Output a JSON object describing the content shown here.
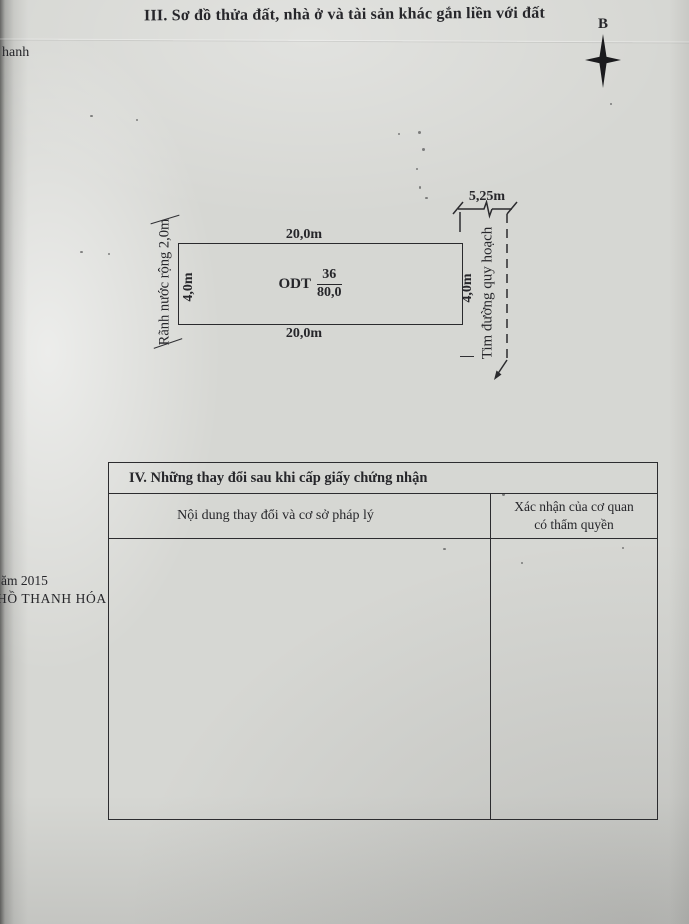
{
  "document": {
    "section_iii_title": "III. Sơ đồ thửa đất, nhà ở và tài sản khác gắn liền với đất",
    "compass_north": "B",
    "edge_fragments": {
      "top_left": "hanh",
      "left_line1": "ăm 2015",
      "left_line2": "HỒ THANH HÓA"
    }
  },
  "diagram": {
    "top_dimension": "20,0m",
    "bottom_dimension": "20,0m",
    "left_dimension": "4,0m",
    "right_dimension": "4,0m",
    "parcel": {
      "land_use_code": "ODT",
      "parcel_number": "36",
      "area": "80,0"
    },
    "left_feature_label": "Rãnh nước rộng 2,0m",
    "right_feature_label": "Tim đường quy hoạch",
    "road_width_dimension": "5,25m"
  },
  "changes_table": {
    "section_iv_title": "IV. Những thay đổi sau khi cấp giấy chứng nhận",
    "col1_header": "Nội dung thay đổi và cơ sở pháp lý",
    "col2_header_line1": "Xác nhận của cơ quan",
    "col2_header_line2": "có thẩm quyền"
  },
  "colors": {
    "paper": "#d6d7d3",
    "ink": "#26262a"
  }
}
